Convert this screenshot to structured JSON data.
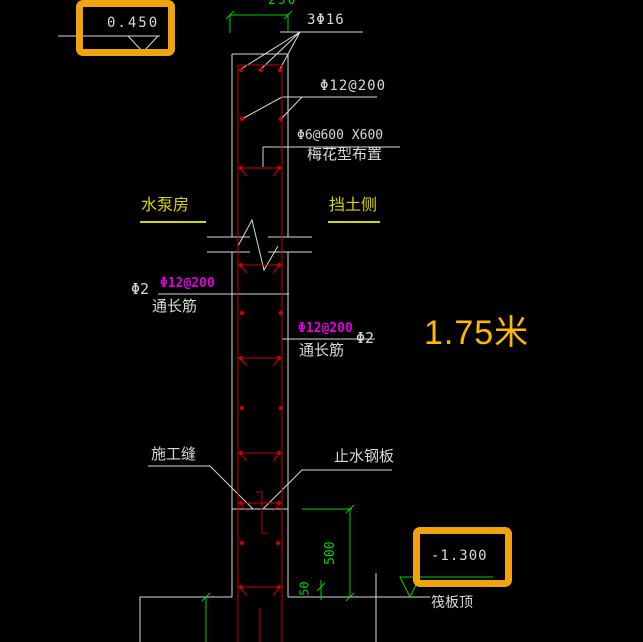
{
  "colors": {
    "background": "#000000",
    "line_white": "#D9D9D9",
    "rebar_red": "#CC0000",
    "dim_green": "#00D400",
    "label_yellow": "#D6D600",
    "bar_magenta": "#DD00DD",
    "highlight_orange": "#F0A30A",
    "annotation_gold": "#FFB800"
  },
  "elevation_markers": {
    "top": {
      "value": "0.450"
    },
    "bottom": {
      "value": "-1.300",
      "caption": "筏板顶"
    }
  },
  "dimensions": {
    "wall_width": "250",
    "base_height": "500",
    "cover": "50"
  },
  "rebar_labels": {
    "top_bars": "3Φ16",
    "horizontal_bars": "Φ12@200",
    "tie_bars_line1": "Φ6@600 X600",
    "tie_bars_line2": "梅花型布置",
    "left_bar_mark": "Φ2",
    "left_bar_spec": "Φ12@200",
    "left_bar_note": "通长筋",
    "right_bar_spec": "Φ12@200",
    "right_bar_note": "通长筋",
    "right_bar_mark": "Φ2"
  },
  "side_labels": {
    "left": "水泵房",
    "right": "挡土侧"
  },
  "notes": {
    "construction_joint": "施工缝",
    "waterstop_plate": "止水钢板"
  },
  "annotation": {
    "length": "1.75米"
  }
}
